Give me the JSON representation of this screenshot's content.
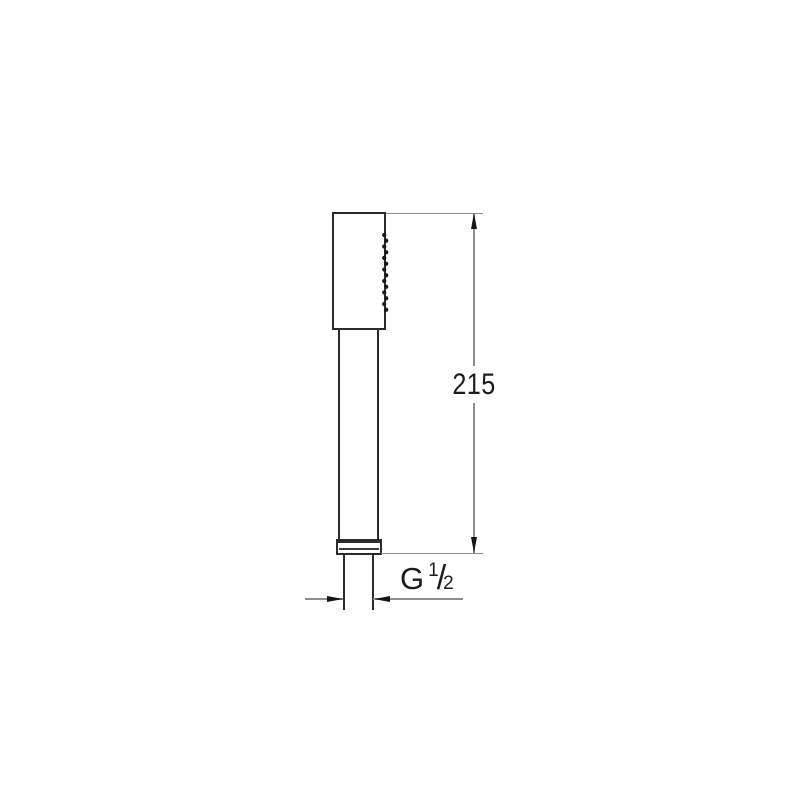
{
  "page": {
    "background": "#ffffff"
  },
  "drawing": {
    "labels": {
      "height": "215",
      "thread_prefix": "G",
      "thread_numerator": "1",
      "thread_slash": "/",
      "thread_denominator": "2"
    },
    "nozzles": {
      "count": 14
    },
    "colors": {
      "outline": "#2b2b2b",
      "dim_line": "#8d8d8d",
      "ink": "#1c1c1c"
    }
  }
}
